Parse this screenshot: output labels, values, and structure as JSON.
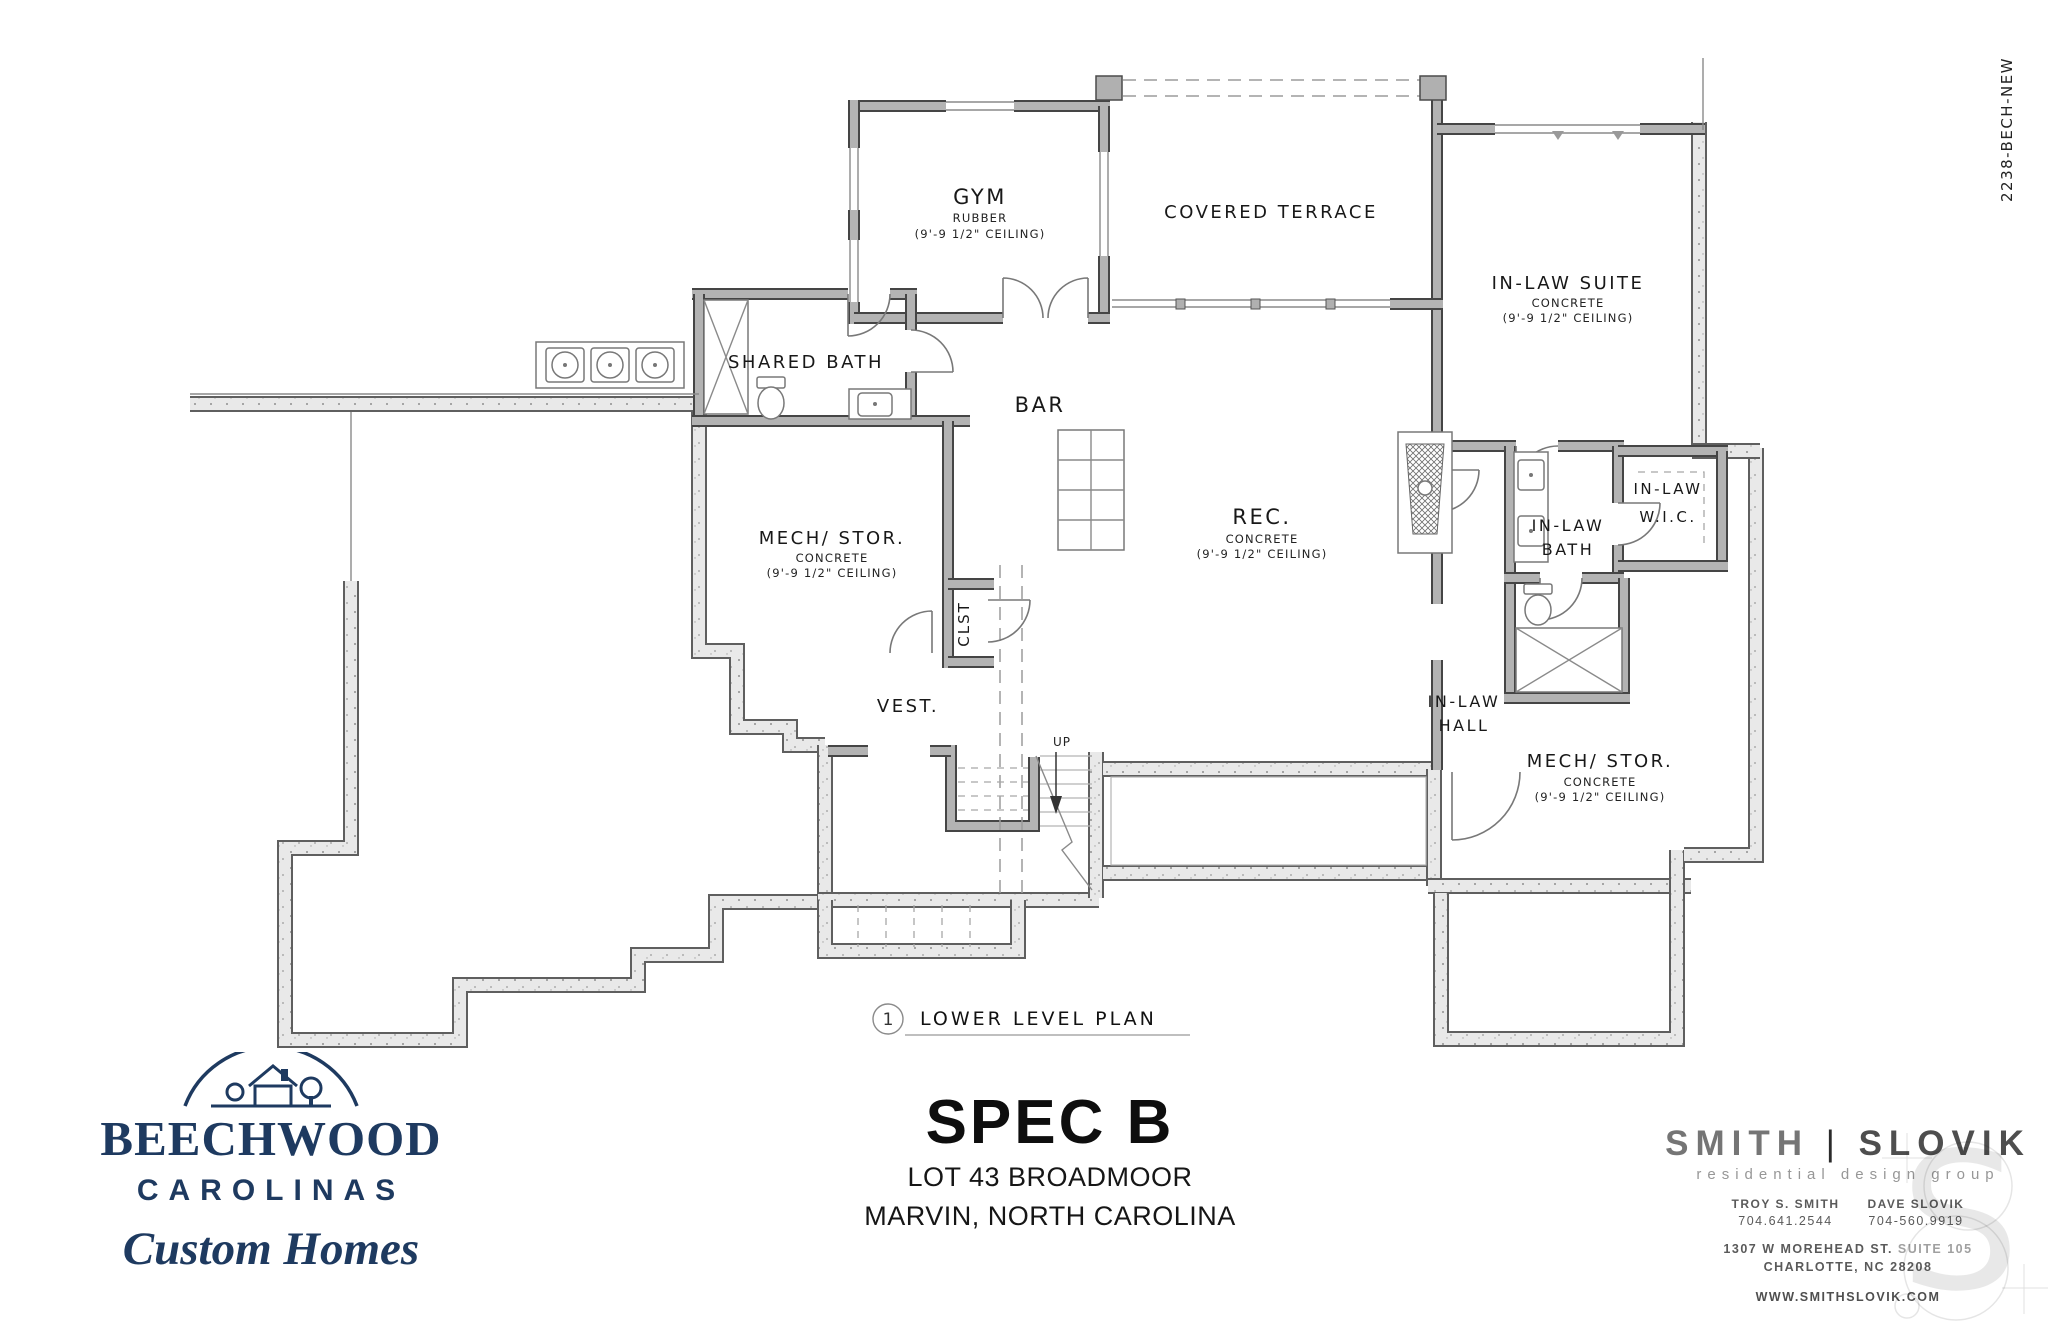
{
  "sheet": {
    "code": "2238-BECH-NEW"
  },
  "plan": {
    "callout_number": "1",
    "title": "LOWER LEVEL PLAN",
    "stair_label": "UP",
    "rooms": [
      {
        "name": "GYM",
        "sub1": "RUBBER",
        "sub2": "(9'-9 1/2\" CEILING)"
      },
      {
        "name": "COVERED TERRACE"
      },
      {
        "name": "IN-LAW SUITE",
        "sub1": "CONCRETE",
        "sub2": "(9'-9 1/2\" CEILING)"
      },
      {
        "name": "SHARED BATH"
      },
      {
        "name": "BAR"
      },
      {
        "name": "REC.",
        "sub1": "CONCRETE",
        "sub2": "(9'-9 1/2\" CEILING)"
      },
      {
        "name": "MECH/ STOR.",
        "sub1": "CONCRETE",
        "sub2": "(9'-9 1/2\" CEILING)"
      },
      {
        "name": "CLST"
      },
      {
        "name": "VEST."
      },
      {
        "name": "IN-LAW",
        "name2": "HALL"
      },
      {
        "name": "IN-LAW",
        "name2": "BATH"
      },
      {
        "name": "IN-LAW",
        "name2": "W.I.C."
      },
      {
        "name": "MECH/ STOR.",
        "sub1": "CONCRETE",
        "sub2": "(9'-9 1/2\" CEILING)"
      }
    ]
  },
  "builder": {
    "line1": "BEECHWOOD",
    "line2": "CAROLINAS",
    "line3": "Custom Homes"
  },
  "project": {
    "name": "SPEC B",
    "lot": "LOT 43 BROADMOOR",
    "location": "MARVIN, NORTH CAROLINA"
  },
  "designer": {
    "firm1": "SMITH",
    "divider": "|",
    "firm2": "SLOVIK",
    "tagline": "residential design group",
    "contact1_name": "TROY S. SMITH",
    "contact1_phone": "704.641.2544",
    "contact2_name": "DAVE SLOVIK",
    "contact2_phone": "704-560.9919",
    "address_street": "1307 W MOREHEAD ST.",
    "address_suite": "SUITE 105",
    "address_city": "CHARLOTTE, NC 28208",
    "website": "WWW.SMITHSLOVIK.COM"
  },
  "colors": {
    "logo_navy": "#1e3a60",
    "wall_gray": "#b3b3b3",
    "concrete": "#e9e9e9",
    "line_dark": "#454545"
  }
}
